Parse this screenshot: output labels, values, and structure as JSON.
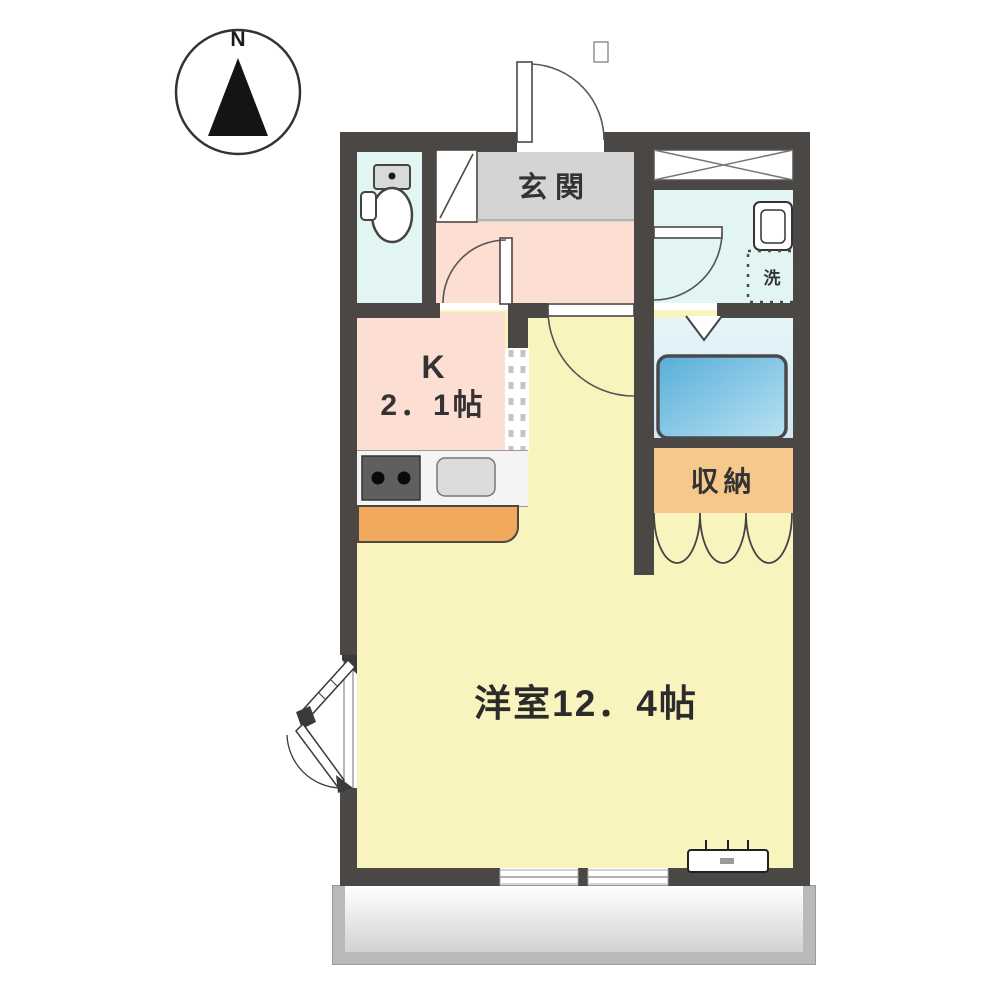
{
  "plan": {
    "title": "one-room apartment floor plan",
    "compass": {
      "label": "N"
    },
    "rooms": {
      "entrance": {
        "label": "玄関"
      },
      "kitchen": {
        "label": "K",
        "size": "2．1帖"
      },
      "living": {
        "label": "洋室12．4帖"
      },
      "storage": {
        "label": "収納"
      },
      "laundry": {
        "label": "洗"
      }
    },
    "fixtures": [
      "north-compass",
      "toilet",
      "shoe-cabinet",
      "entrance-door",
      "washbasin",
      "washing-machine-space",
      "bathtub",
      "bathroom-folding-door",
      "gas-stove",
      "kitchen-sink",
      "kitchen-counter",
      "storage-accordion-door",
      "casement-window",
      "air-conditioner",
      "balcony",
      "sliding-windows"
    ],
    "colors": {
      "wall": "#4a4744",
      "entrance_floor": "#d4d4d4",
      "hall_kitchen_floor": "#fcdfd2",
      "living_floor": "#f9f4bd",
      "sanitary_floor": "#e2f5f3",
      "bath_floor": "#cfe9f2",
      "bathtub": "#5fb2dc",
      "storage_floor": "#f6c88c",
      "counter": "#f0a95c",
      "balcony": "#d2d2d2"
    }
  }
}
